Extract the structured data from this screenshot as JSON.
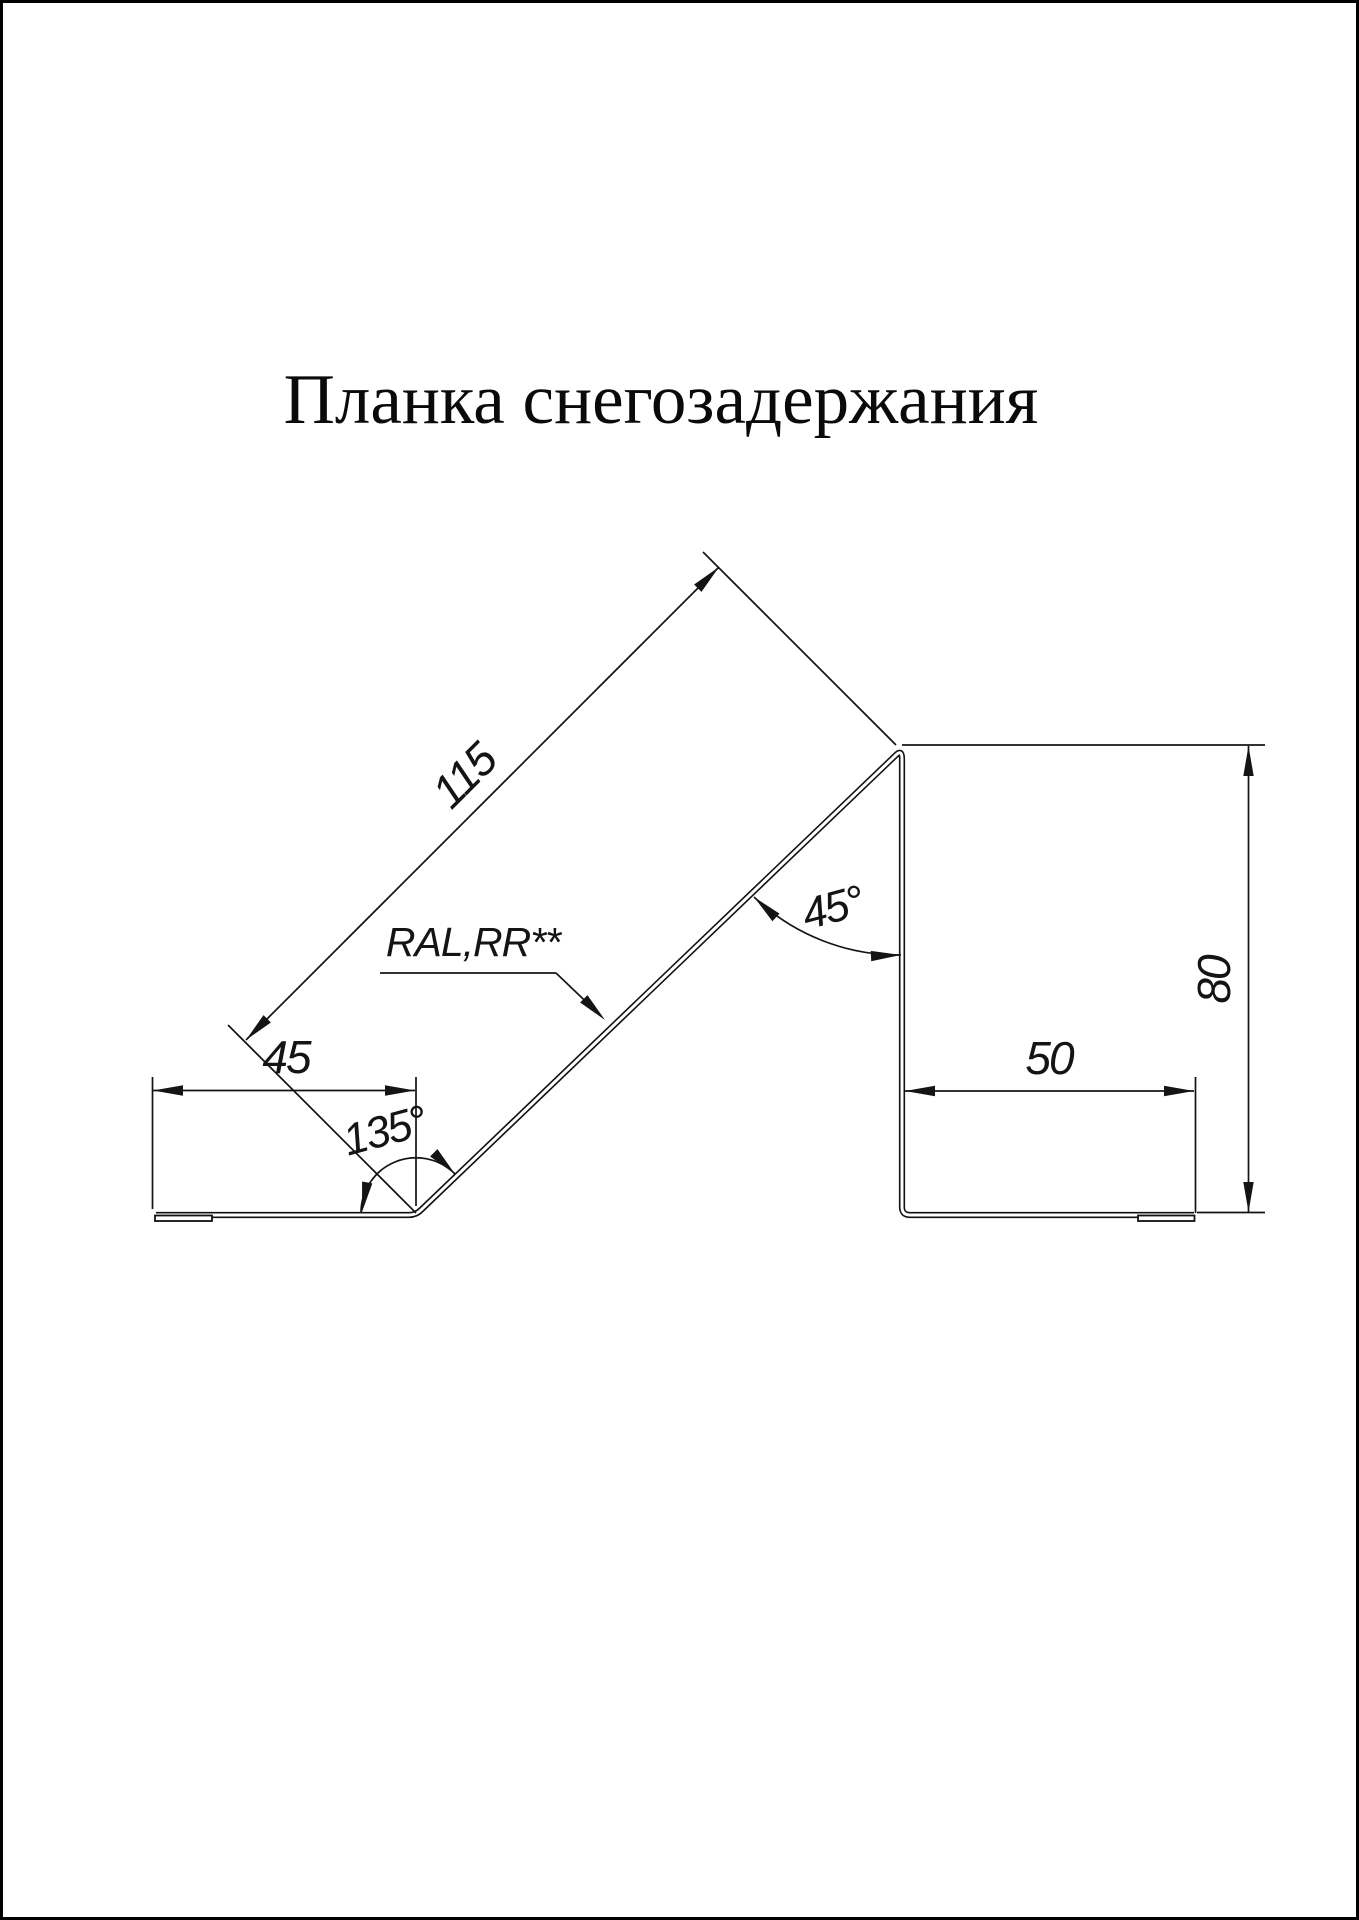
{
  "title": "Планка снегозадержания",
  "dimensions": {
    "slope_length": "115",
    "left_flange_width": "45",
    "bottom_bend_angle": "135°",
    "top_bend_angle": "45°",
    "right_flange_width": "50",
    "profile_height": "80"
  },
  "annotations": {
    "coating_label": "RAL,RR**"
  },
  "colors": {
    "line": "#141414",
    "background": "#ffffff",
    "border": "#000000"
  }
}
